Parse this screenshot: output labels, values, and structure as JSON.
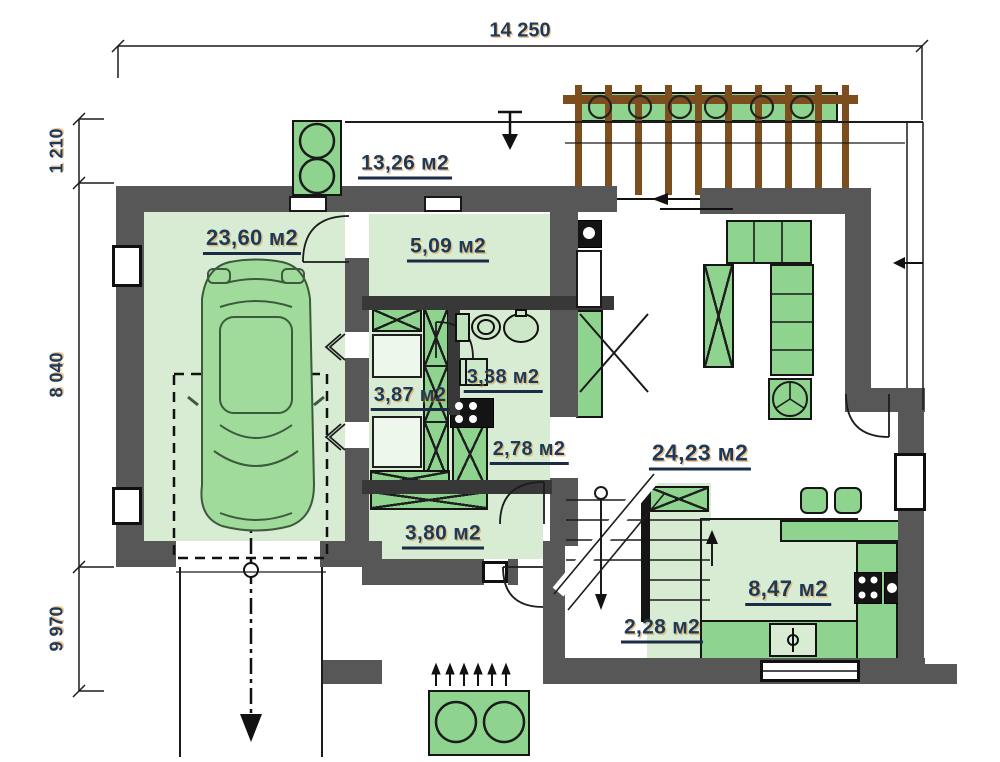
{
  "dimensions": {
    "total_width": "14 250",
    "left_top": "1 210",
    "left_middle": "8 040",
    "left_bottom": "9 970"
  },
  "rooms": {
    "terrace": "13,26 м2",
    "garage": "23,60 м2",
    "vestibule": "5,09 м2",
    "utility": "3,87 м2",
    "bathroom": "3,38 м2",
    "corridor": "2,78 м2",
    "hall": "3,80 м2",
    "living_room": "24,23 м2",
    "kitchen": "8,47 м2",
    "pantry": "2,28 м2"
  },
  "colors": {
    "wall": "#575757",
    "partition": "#383838",
    "room": "#d8ecd4",
    "furniture": "#8ed48f",
    "car": "#a0db9b",
    "pergola": "#7d4e1d",
    "label": "#1d3a5c",
    "line": "#1c1c1c"
  }
}
